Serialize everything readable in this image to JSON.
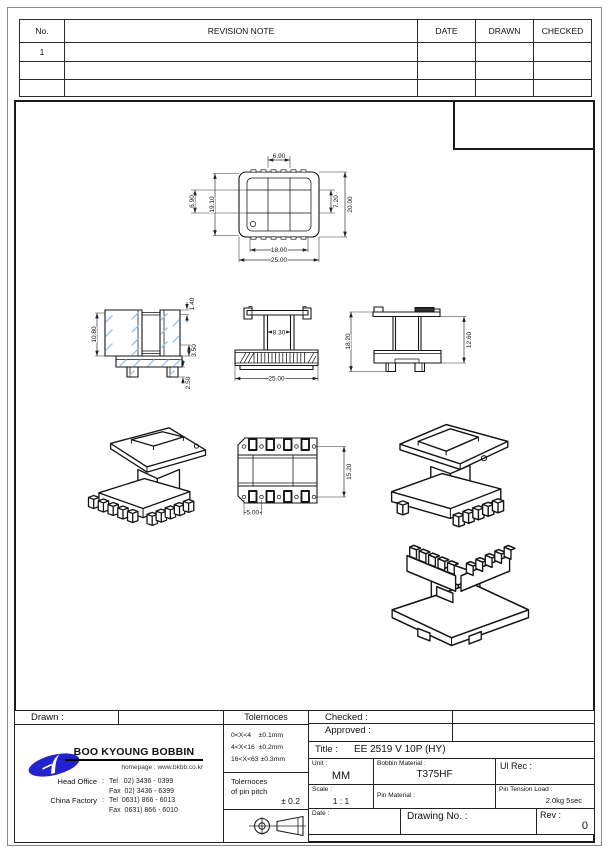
{
  "revision_table": {
    "headers": [
      "No.",
      "REVISION  NOTE",
      "DATE",
      "DRAWN",
      "CHECKED"
    ],
    "rows": [
      [
        "1",
        "",
        "",
        "",
        ""
      ],
      [
        "",
        "",
        "",
        "",
        ""
      ],
      [
        "",
        "",
        "",
        "",
        ""
      ]
    ]
  },
  "dims": {
    "top": {
      "width_top": "6.90",
      "left": "6.90",
      "inner_h": "19.10",
      "slot_h": "7.20",
      "outer_h": "20.00",
      "inner_w": "18.00",
      "outer_w": "25.00"
    },
    "section": {
      "rib": "1.40",
      "height": "10.80",
      "flange": "3.50",
      "foot": "2.50"
    },
    "front": {
      "tube": "8.30",
      "width": "25.00"
    },
    "side": {
      "height": "18.20",
      "body": "12.60"
    },
    "bottom": {
      "pin_span": "15.20",
      "pin_pitch": "5.00"
    }
  },
  "title_block": {
    "drawn_label": "Drawn :",
    "checked_label": "Checked :",
    "approved_label": "Approved :",
    "title_label": "Title :",
    "title_value": "EE 2519 V 10P (HY)",
    "unit_label": "Unit :",
    "unit_value": "MM",
    "bobbin_material_label": "Bobbin Material :",
    "bobbin_material_value": "T375HF",
    "ul_rec_label": "Ul Rec :",
    "scale_label": "Scale :",
    "scale_value": "1 : 1",
    "pin_material_label": "Pin Material :",
    "pin_tension_label": "Pin Tension Load :",
    "pin_tension_value": "2.0kg 5sec",
    "date_label": "Date :",
    "drawing_no_label": "Drawing No.  :",
    "rev_label": "Rev :",
    "rev_value": "0",
    "tolerances_header": "Tolernoces",
    "tolerance_lines": "0<X<4    ±0.1mm\n4<X<16  ±0.2mm\n16<X<63 ±0.3mm",
    "pin_pitch_label": "Tolernoces\nof pin pitch",
    "pin_pitch_value": "± 0.2"
  },
  "company": {
    "name": "BOO KYOUNG BOBBIN",
    "homepage": "homepage : www.bkbb.co.kr",
    "rows": [
      {
        "label": "Head Office",
        "sep": ":",
        "text": "Tel   02) 3436 - 0399"
      },
      {
        "label": "",
        "sep": "",
        "text": "Fax  02) 3436 - 6399"
      },
      {
        "label": "China Factory",
        "sep": ":",
        "text": "Tel  0631) 866 - 6013"
      },
      {
        "label": "",
        "sep": "",
        "text": "Fax  0631) 866 - 6010"
      }
    ]
  },
  "colors": {
    "logo_blue": "#2222cc",
    "hatch_blue": "#9dc3e6",
    "line": "#1a1a1a"
  }
}
